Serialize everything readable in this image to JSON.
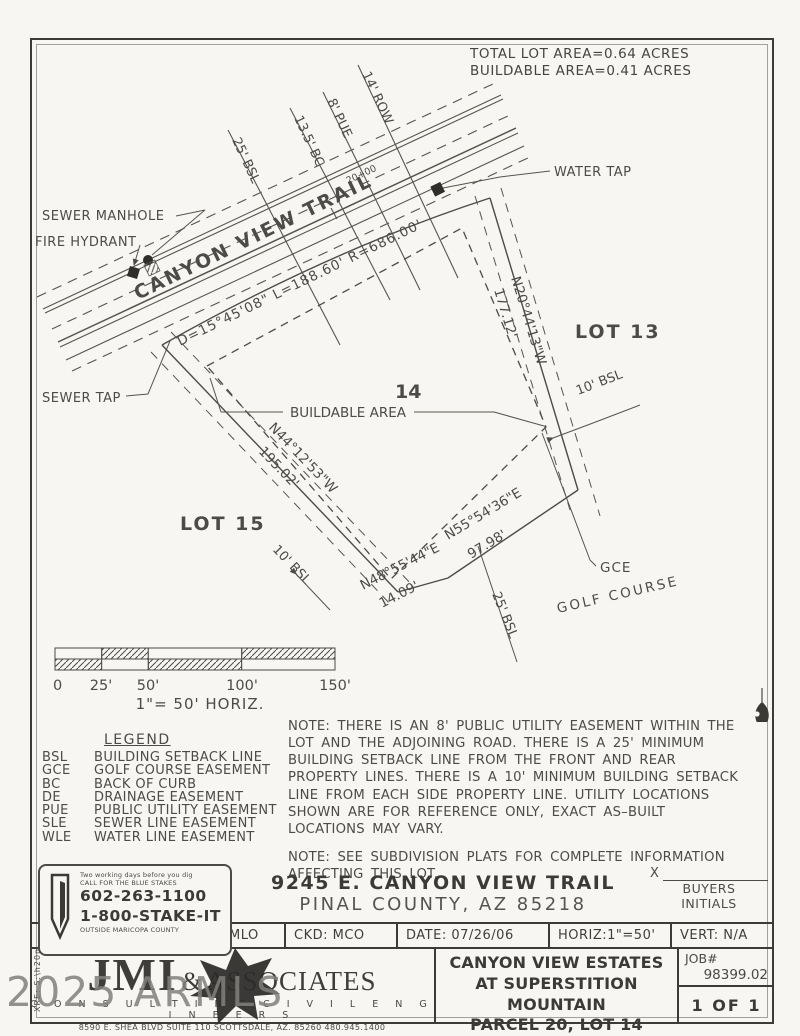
{
  "colors": {
    "ink": "#4c4b49",
    "paper": "#f7f6f2",
    "watermark": "#80807d"
  },
  "header": {
    "total_lot_area": "TOTAL LOT AREA=0.64 ACRES",
    "buildable_area": "BUILDABLE AREA=0.41 ACRES"
  },
  "plan": {
    "road_name": "CANYON VIEW TRAIL",
    "curve_data": "D=15°45'08\"  L=188.60'  R=686.00'",
    "station": "20+00",
    "callout_bsl": "25' BSL",
    "callout_bc": "13.5' BC",
    "callout_pue": "8' PUE",
    "callout_row": "14' ROW",
    "water_tap": "WATER TAP",
    "sewer_manhole": "SEWER MANHOLE",
    "fire_hydrant": "FIRE HYDRANT",
    "sewer_tap": "SEWER TAP",
    "lot13": "LOT 13",
    "lot15": "LOT 15",
    "lot_number": "14",
    "buildable_label": "BUILDABLE AREA",
    "bsl10_right": "10' BSL",
    "bsl10_left": "10' BSL",
    "bsl25_bottom": "25' BSL",
    "gce": "GCE",
    "golf_course": "GOLF COURSE",
    "bearing_right": "N20°44'13\"W",
    "dist_right": "177.12'",
    "bearing_left": "N44°12'53\"W",
    "dist_left": "195.02'",
    "bearing_bottom": "N55°54'36\"E",
    "dist_bottom": "97.98'",
    "bearing_bottom_short": "N48°55'44\"E",
    "dist_bottom_short": "14.09'"
  },
  "scale_bar": {
    "ticks": [
      "0",
      "25'",
      "50'",
      "100'",
      "150'"
    ],
    "caption": "1\"= 50'   HORIZ."
  },
  "legend": {
    "title": "LEGEND",
    "items": [
      {
        "abbr": "BSL",
        "desc": "BUILDING SETBACK LINE"
      },
      {
        "abbr": "GCE",
        "desc": "GOLF COURSE EASEMENT"
      },
      {
        "abbr": "BC",
        "desc": "BACK OF CURB"
      },
      {
        "abbr": "DE",
        "desc": "DRAINAGE EASEMENT"
      },
      {
        "abbr": "PUE",
        "desc": "PUBLIC UTILITY EASEMENT"
      },
      {
        "abbr": "SLE",
        "desc": "SEWER LINE EASEMENT"
      },
      {
        "abbr": "WLE",
        "desc": "WATER LINE EASEMENT"
      }
    ]
  },
  "notes": {
    "note1": "NOTE: THERE IS AN 8' PUBLIC UTILITY EASEMENT WITHIN THE LOT AND THE ADJOINING ROAD. THERE IS A 25' MINIMUM BUILDING SETBACK LINE FROM THE FRONT AND REAR PROPERTY LINES. THERE IS A 10' MINIMUM BUILDING SETBACK LINE FROM EACH SIDE PROPERTY LINE. UTILITY LOCATIONS SHOWN ARE FOR REFERENCE ONLY, EXACT AS–BUILT LOCATIONS MAY VARY.",
    "note2": "NOTE: SEE SUBDIVISION PLATS FOR COMPLETE INFORMATION AFFECTING THIS LOT."
  },
  "address": {
    "line1": "9245 E. CANYON VIEW TRAIL",
    "line2": "PINAL COUNTY, AZ 85218"
  },
  "buyers": {
    "x": "X",
    "line1": "BUYERS",
    "line2": "INITIALS"
  },
  "title_block": {
    "dsn": "DSN: MLO",
    "ckd": "CKD: MCO",
    "date": "DATE:  07/26/06",
    "horiz": "HORIZ:1\"=50'",
    "vert": "VERT: N/A"
  },
  "blue_stakes": {
    "line1": "Two working days before you dig",
    "line2": "CALL FOR THE BLUE STAKES",
    "phone1": "602-263-1100",
    "phone2": "1-800-STAKE-IT",
    "line3": "OUTSIDE MARICOPA COUNTY"
  },
  "firm": {
    "name_main": "JMI",
    "amp": "&",
    "name_rest": "ASSOCIATES",
    "tagline": "C O N S U L T I N G   C I V I L   E N G I N E E R S",
    "address": "8590 E. SHEA BLVD SUITE 110 SCOTTSDALE, AZ. 85260 480.945.1400"
  },
  "project": {
    "line1": "CANYON VIEW ESTATES",
    "line2": "AT SUPERSTITION MOUNTAIN",
    "line3": "PARCEL 20, LOT 14",
    "job_label": "JOB#",
    "job_number": "98399.02",
    "sheet": "1 OF 1"
  },
  "watermark": {
    "text": "2025 ARMLS"
  },
  "edge_text": "XRE: S:\\h20m"
}
